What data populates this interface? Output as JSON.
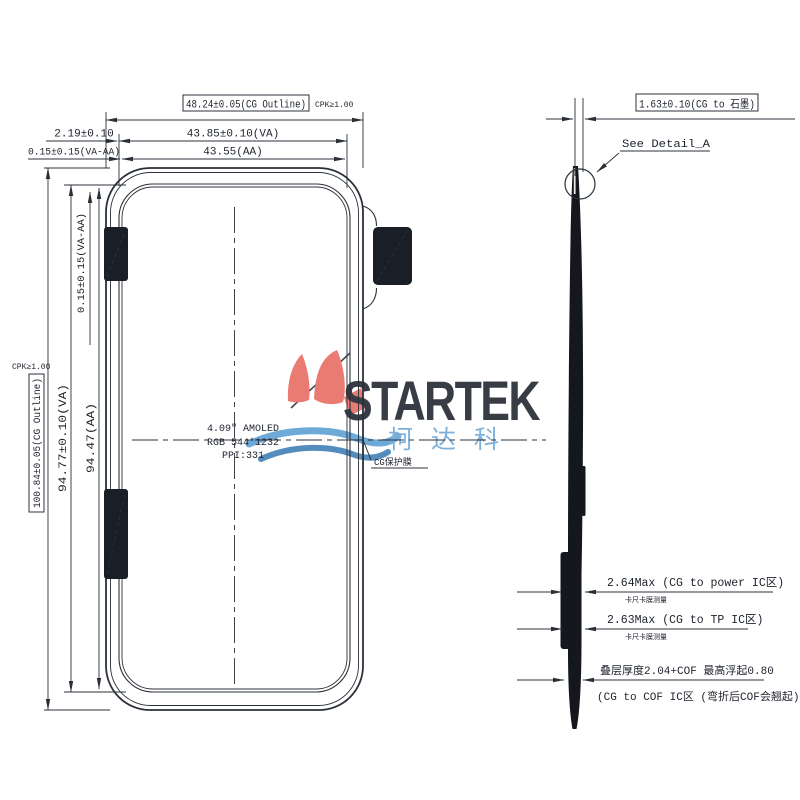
{
  "drawing": {
    "type": "display-module-dimension-drawing",
    "colors": {
      "line": "#2b3038",
      "dark_fill": "#1a1e26",
      "logo_red": "#e8695f",
      "logo_blue": "#5b9fd2",
      "logo_blue_dark": "#3d7eb5",
      "logo_steel": "#8c9cab"
    }
  },
  "front_view": {
    "dim_cg_width": "48.24±0.05(CG Outline)",
    "cpk_top": "CPK≥1.00",
    "dim_va_width": "43.85±0.10(VA)",
    "dim_aa_width": "43.55(AA)",
    "dim_cg_va_offset": "2.19±0.10",
    "dim_va_aa_offset_top": "0.15±0.15(VA-AA)",
    "cpk_left": "CPK≥1.00",
    "dim_cg_height": "100.84±0.05(CG Outline)",
    "dim_va_height": "94.77±0.10(VA)",
    "dim_aa_height": "94.47(AA)",
    "dim_va_aa_offset_left": "0.15±0.15(VA-AA)",
    "panel_line1": "4.09\" AMOLED",
    "panel_line2": "RGB 544*1232",
    "panel_line3": "PPI:331",
    "cg_film_label": "CG保护膜"
  },
  "side_view": {
    "dim_cg_graphite": "1.63±0.10(CG to 石墨)",
    "see_detail": "See Detail_A",
    "dim_power_ic": "2.64Max (CG to power IC区)",
    "note_power_ic": "卡尺卡膜测量",
    "dim_tp_ic": "2.63Max (CG to TP IC区)",
    "note_tp_ic": "卡尺卡膜测量",
    "dim_cof_line1": "叠层厚度2.04+COF 最高浮起0.80",
    "dim_cof_line2": "(CG to COF IC区 (弯折后COF会翘起))"
  },
  "logo": {
    "wordmark": "STARTEK",
    "cn": "柯达科"
  }
}
